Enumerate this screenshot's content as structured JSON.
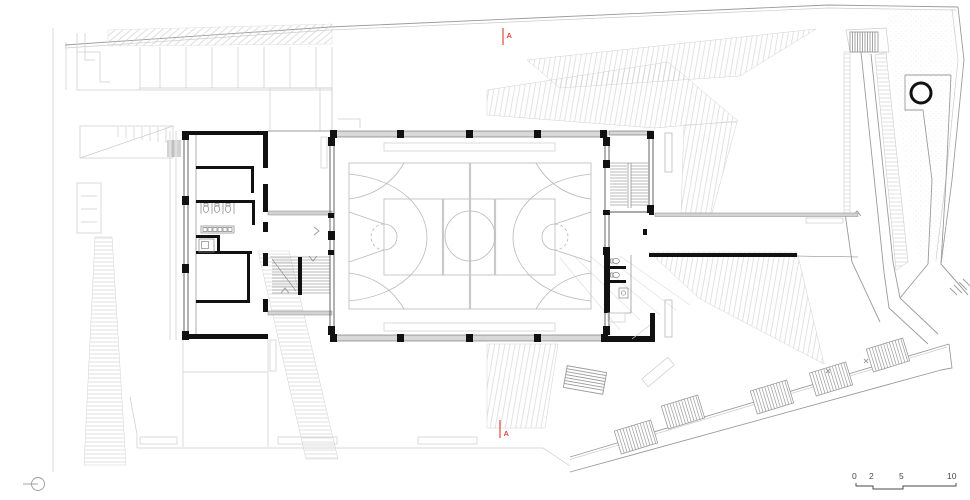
{
  "meta": {
    "type": "architectural-floor-plan",
    "subject": "sports-hall-ground-floor-site-plan"
  },
  "annotations": {
    "section_marker_top": "A",
    "section_marker_bottom": "A",
    "scale_bar": {
      "labels": [
        "0",
        "2",
        "5",
        "10"
      ]
    }
  },
  "colors": {
    "section_marker": "#e2493d",
    "walls": "#111111",
    "site_lines": "#c9c9c9",
    "mid_lines": "#9b9b9b",
    "court_lines": "#b9b9b9",
    "wall_fill": "#d8d8d8"
  }
}
